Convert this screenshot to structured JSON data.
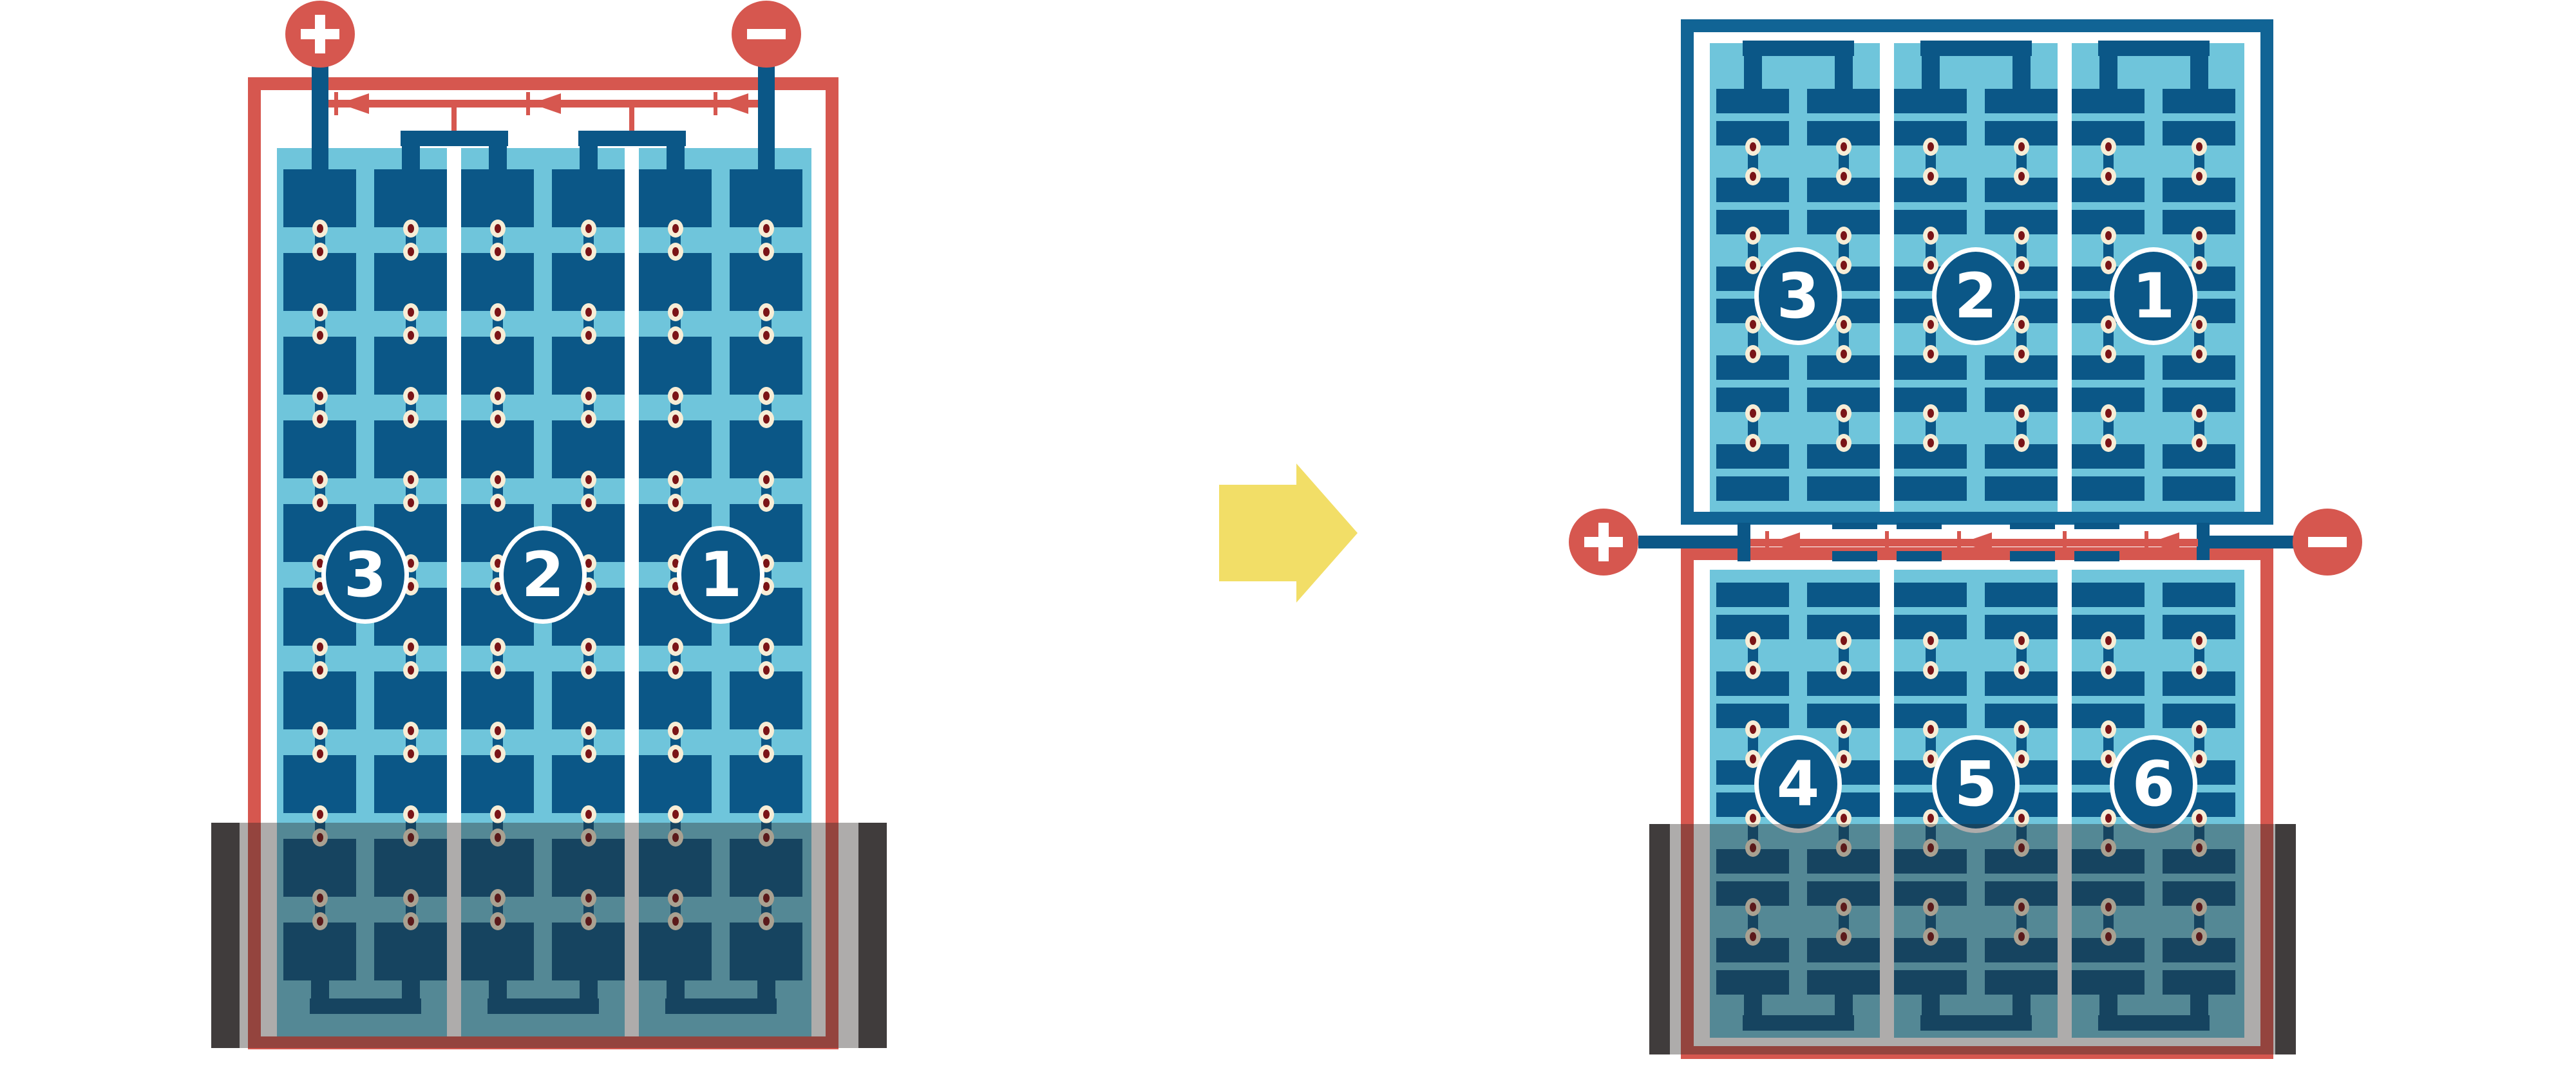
{
  "diagram_title": "full-cell module vs half-cell split module wiring",
  "colors": {
    "background": "#ffffff",
    "red": "#D6574F",
    "navy": "#0B5787",
    "blue_frame": "#116495",
    "light_blue": "#6FC5DB",
    "white": "#ffffff",
    "dot_cream": "#F7EDD6",
    "dot_maroon": "#7A1417",
    "arrow_yellow": "#F2DE67",
    "shade_overlay": "rgba(43,37,34,0.38)",
    "shade_post": "#403C3C"
  },
  "left_module": {
    "kind": "full-cell-module",
    "frame_color": "#D6574F",
    "terminal_positive": "+",
    "terminal_negative": "-",
    "bypass_diode_count": 3,
    "cell_rows": 10,
    "sub_columns_per_string": 2,
    "strings": [
      {
        "label": "3"
      },
      {
        "label": "2"
      },
      {
        "label": "1"
      }
    ],
    "shade": "bottom"
  },
  "right_module": {
    "kind": "half-cell-module",
    "terminal_positive": "+",
    "terminal_negative": "-",
    "bypass_diode_count": 3,
    "top_half": {
      "frame_color": "#116495",
      "row_pairs": 5,
      "strings": [
        {
          "label": "3"
        },
        {
          "label": "2"
        },
        {
          "label": "1"
        }
      ]
    },
    "bottom_half": {
      "frame_color": "#D6574F",
      "row_pairs": 5,
      "strings": [
        {
          "label": "4"
        },
        {
          "label": "5"
        },
        {
          "label": "6"
        }
      ]
    },
    "shade": "bottom"
  },
  "transform_arrow": {
    "direction": "right",
    "color": "#F2DE67"
  }
}
